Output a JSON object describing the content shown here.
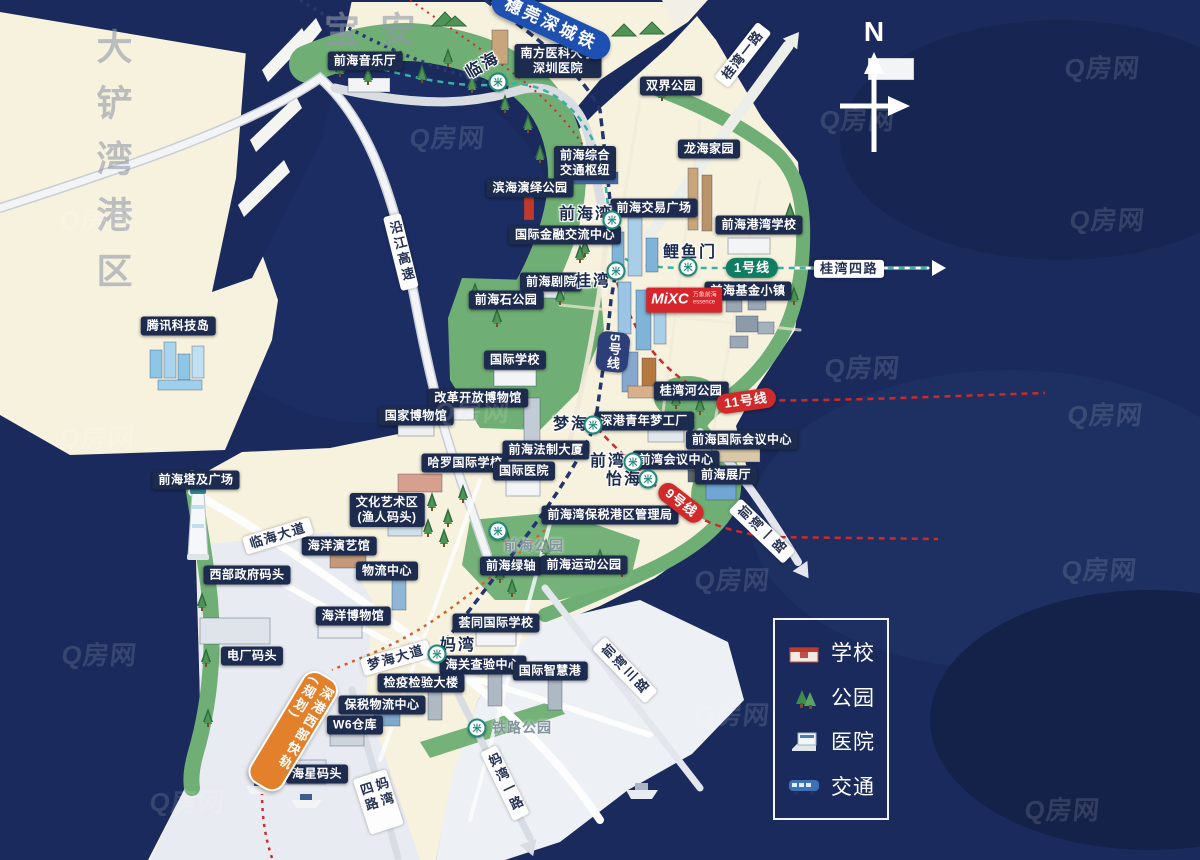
{
  "compass": {
    "label": "N"
  },
  "watermark": {
    "text": "Q房网"
  },
  "legend": {
    "items": [
      {
        "icon": "school-icon",
        "label": "学校"
      },
      {
        "icon": "park-icon",
        "label": "公园"
      },
      {
        "icon": "hospital-icon",
        "label": "医院"
      },
      {
        "icon": "transit-icon",
        "label": "交通"
      }
    ]
  },
  "areas": [
    {
      "text": "宝安",
      "x": 380,
      "y": 30,
      "vertical": false
    },
    {
      "text": "大铲湾港区",
      "x": 112,
      "y": 168,
      "vertical": true
    }
  ],
  "pois": [
    {
      "text": "前海音乐厅",
      "x": 365,
      "y": 61
    },
    {
      "text": "南方医科大学\n深圳医院",
      "x": 558,
      "y": 61
    },
    {
      "text": "双界公园",
      "x": 671,
      "y": 86
    },
    {
      "text": "龙海家园",
      "x": 709,
      "y": 149
    },
    {
      "text": "前海综合\n交通枢纽",
      "x": 585,
      "y": 163
    },
    {
      "text": "滨海演绎公园",
      "x": 530,
      "y": 188
    },
    {
      "text": "前海交易广场",
      "x": 654,
      "y": 208
    },
    {
      "text": "国际金融交流中心",
      "x": 565,
      "y": 235
    },
    {
      "text": "前海港湾学校",
      "x": 759,
      "y": 225
    },
    {
      "text": "前海剧院",
      "x": 551,
      "y": 282
    },
    {
      "text": "前海基金小镇",
      "x": 748,
      "y": 291
    },
    {
      "text": "前海石公园",
      "x": 506,
      "y": 300
    },
    {
      "text": "腾讯科技岛",
      "x": 178,
      "y": 326
    },
    {
      "text": "国际学校",
      "x": 515,
      "y": 360
    },
    {
      "text": "改革开放博物馆",
      "x": 478,
      "y": 398
    },
    {
      "text": "国家博物馆",
      "x": 416,
      "y": 416
    },
    {
      "text": "桂湾河公园",
      "x": 691,
      "y": 391
    },
    {
      "text": "深港青年梦工厂",
      "x": 644,
      "y": 421
    },
    {
      "text": "前海国际会议中心",
      "x": 742,
      "y": 440
    },
    {
      "text": "前海法制大厦",
      "x": 546,
      "y": 450
    },
    {
      "text": "前湾会议中心",
      "x": 676,
      "y": 460
    },
    {
      "text": "哈罗国际学校",
      "x": 465,
      "y": 463
    },
    {
      "text": "国际医院",
      "x": 524,
      "y": 471
    },
    {
      "text": "前海展厅",
      "x": 726,
      "y": 475
    },
    {
      "text": "前海塔及广场",
      "x": 196,
      "y": 480
    },
    {
      "text": "文化艺术区\n(渔人码头)",
      "x": 387,
      "y": 510
    },
    {
      "text": "前海湾保税港区管理局",
      "x": 610,
      "y": 515
    },
    {
      "text": "海洋演艺馆",
      "x": 339,
      "y": 546
    },
    {
      "text": "前海绿轴",
      "x": 511,
      "y": 566
    },
    {
      "text": "前海运动公园",
      "x": 584,
      "y": 565
    },
    {
      "text": "物流中心",
      "x": 387,
      "y": 571
    },
    {
      "text": "西部政府码头",
      "x": 247,
      "y": 575
    },
    {
      "text": "海洋博物馆",
      "x": 353,
      "y": 616
    },
    {
      "text": "荟同国际学校",
      "x": 496,
      "y": 623
    },
    {
      "text": "电厂码头",
      "x": 252,
      "y": 656
    },
    {
      "text": "海关查验中心",
      "x": 483,
      "y": 665
    },
    {
      "text": "国际智慧港",
      "x": 550,
      "y": 671
    },
    {
      "text": "检疫检验大楼",
      "x": 421,
      "y": 683
    },
    {
      "text": "保税物流中心",
      "x": 382,
      "y": 705
    },
    {
      "text": "W6仓库",
      "x": 355,
      "y": 725
    },
    {
      "text": "海星码头",
      "x": 317,
      "y": 774
    }
  ],
  "stations": [
    {
      "text": "临海",
      "x": 483,
      "y": 66,
      "rot": -30
    },
    {
      "text": "前海湾",
      "x": 586,
      "y": 215,
      "rot": 0
    },
    {
      "text": "鲤鱼门",
      "x": 690,
      "y": 253,
      "rot": 0
    },
    {
      "text": "桂湾",
      "x": 593,
      "y": 282,
      "rot": 0
    },
    {
      "text": "梦海",
      "x": 571,
      "y": 425,
      "rot": 0
    },
    {
      "text": "前湾",
      "x": 608,
      "y": 462,
      "rot": 0
    },
    {
      "text": "怡海",
      "x": 624,
      "y": 480,
      "rot": 0
    },
    {
      "text": "妈湾",
      "x": 458,
      "y": 646,
      "rot": 0
    }
  ],
  "station_icon": {
    "glyph": "米"
  },
  "station_icons": [
    {
      "x": 498,
      "y": 82
    },
    {
      "x": 612,
      "y": 220
    },
    {
      "x": 688,
      "y": 267
    },
    {
      "x": 616,
      "y": 271
    },
    {
      "x": 593,
      "y": 425
    },
    {
      "x": 633,
      "y": 462
    },
    {
      "x": 648,
      "y": 479
    },
    {
      "x": 437,
      "y": 654
    },
    {
      "x": 498,
      "y": 531
    },
    {
      "x": 477,
      "y": 728
    }
  ],
  "parks": [
    {
      "text": "前海公园",
      "x": 534,
      "y": 546
    },
    {
      "text": "铁路公园",
      "x": 522,
      "y": 728
    }
  ],
  "roads": [
    {
      "text": "沿江高速",
      "x": 401,
      "y": 252,
      "rot": -14,
      "vertical": true
    },
    {
      "text": "桂湾一路",
      "x": 743,
      "y": 55,
      "rot": -52,
      "vertical": false
    },
    {
      "text": "桂湾四路",
      "x": 849,
      "y": 269,
      "rot": 0,
      "vertical": false
    },
    {
      "text": "临海大道",
      "x": 278,
      "y": 536,
      "rot": -17,
      "vertical": false
    },
    {
      "text": "梦海大道",
      "x": 396,
      "y": 658,
      "rot": -16,
      "vertical": false
    },
    {
      "text": "妈湾四路",
      "x": 378,
      "y": 802,
      "rot": -18,
      "vertical": true
    },
    {
      "text": "妈湾一路",
      "x": 505,
      "y": 783,
      "rot": -26,
      "vertical": true
    },
    {
      "text": "前湾三路",
      "x": 625,
      "y": 670,
      "rot": -44,
      "vertical": true
    },
    {
      "text": "前湾一路",
      "x": 762,
      "y": 531,
      "rot": -46,
      "vertical": true
    }
  ],
  "line_badges": [
    {
      "text": "1号线",
      "color": "green",
      "x": 752,
      "y": 268,
      "rot": 0,
      "vertical": false
    },
    {
      "text": "5号线",
      "color": "navy",
      "x": 613,
      "y": 352,
      "rot": 6,
      "vertical": true
    },
    {
      "text": "11号线",
      "color": "red",
      "x": 746,
      "y": 401,
      "rot": -8,
      "vertical": false
    },
    {
      "text": "9号线",
      "color": "red",
      "x": 681,
      "y": 503,
      "rot": 38,
      "vertical": false
    }
  ],
  "banners": [
    {
      "text": "穗莞深城铁",
      "style": "blue",
      "x": 551,
      "y": 24,
      "rot": 25,
      "vertical": false
    },
    {
      "text": "深港西部快轨(规划)",
      "style": "orange",
      "x": 293,
      "y": 731,
      "rot": 31,
      "vertical": true
    }
  ],
  "project_badge": {
    "logo": "MiXC",
    "name": "万象前海",
    "sub": "essence",
    "x": 684,
    "y": 300
  },
  "colors": {
    "sea": "#1a2a5c",
    "land": "#f7f2de",
    "green": "#6fae74",
    "gray_land": "#e8ebf1",
    "light_water": "#edf0f4",
    "line1": "#38b2a3",
    "line5": "#24356e",
    "line_red": "#cf2a2a",
    "rail_orange": "#d2622a"
  }
}
